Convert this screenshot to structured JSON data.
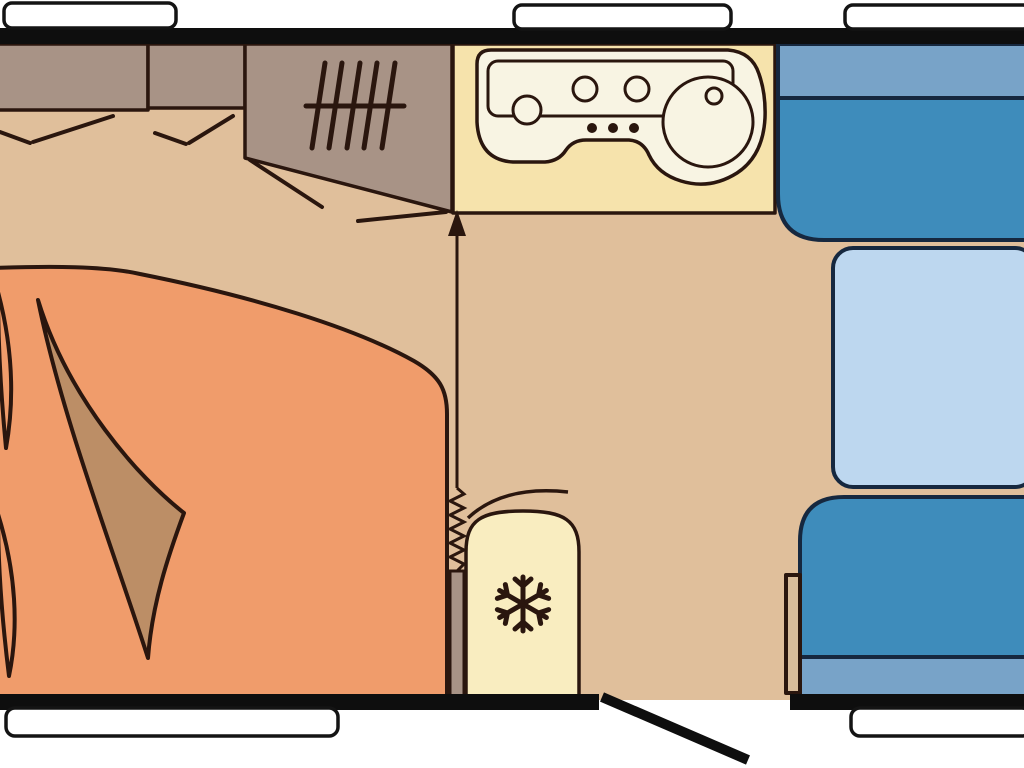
{
  "meta": {
    "type": "caravan-floorplan",
    "description": "top-view floor plan of a caravan interior"
  },
  "colors": {
    "background": "#ffffff",
    "wall": "#0e0e0e",
    "window_fill": "#ffffff",
    "window_stroke": "#141414",
    "floor": "#e0bf9b",
    "outline": "#2a160e",
    "bed": "#f09c6b",
    "blanket": "#bc8e66",
    "cabinet": "#a89386",
    "counter": "#f6e3ac",
    "appliance": "#f8f4e3",
    "fridge": "#f9edc0",
    "seat": "#3e8cbb",
    "backrest": "#78a3c8",
    "seat_outline": "#16283f",
    "table": "#bdd7ef",
    "panel": "#d9bd9b"
  },
  "icons": {
    "heater": "grill-lines-icon",
    "fridge": "snowflake-icon",
    "entry": "open-door-icon",
    "partition": "zigzag-concertina-icon",
    "walkway": "up-arrow-icon"
  }
}
